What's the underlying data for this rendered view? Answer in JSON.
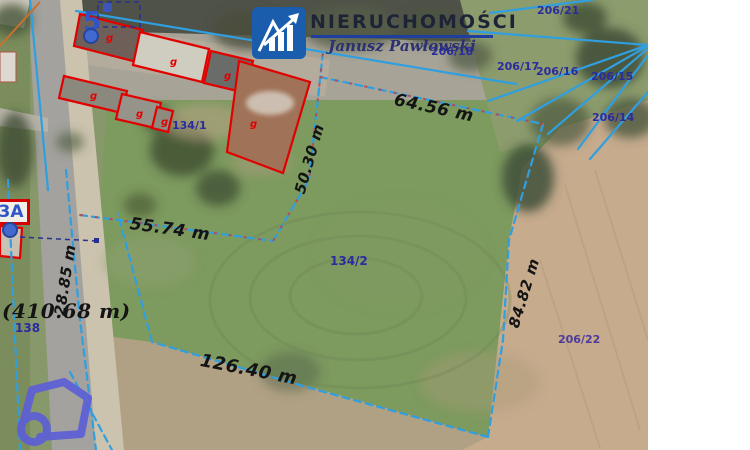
{
  "branding": {
    "agency_name": "NIERUCHOMOŚCI",
    "agent_name": "Janusz Pawłowski"
  },
  "map": {
    "measurements": {
      "north_edge": "64.56 m",
      "west_inner_edge": "50.30 m",
      "middle_edge": "55.74 m",
      "road_frontage": "28.85 m",
      "total_perimeter": "(410.68 m)",
      "south_edge": "126.40 m",
      "east_edge": "84.82 m"
    },
    "parcels": {
      "p206_21": "206/21",
      "p206_18": "206/18",
      "p206_17": "206/17",
      "p206_16": "206/16",
      "p206_15": "206/15",
      "p206_14": "206/14",
      "p206_22": "206/22",
      "p134_1": "134/1",
      "p134_2": "134/2",
      "p138": "138"
    },
    "address_markers": {
      "marker_5": "5",
      "marker_3a": "3A"
    },
    "building_mark": "g",
    "colors": {
      "boundary_blue": "#2f9fe0",
      "building_outline_red": "#e10000",
      "parcel_label_navy": "#2b2ba0",
      "measurement_black": "#141414",
      "marker_blue": "#4169cf",
      "logo_blue": "#1a5dad",
      "portal_swirl_purple": "#5d5fd6"
    }
  }
}
